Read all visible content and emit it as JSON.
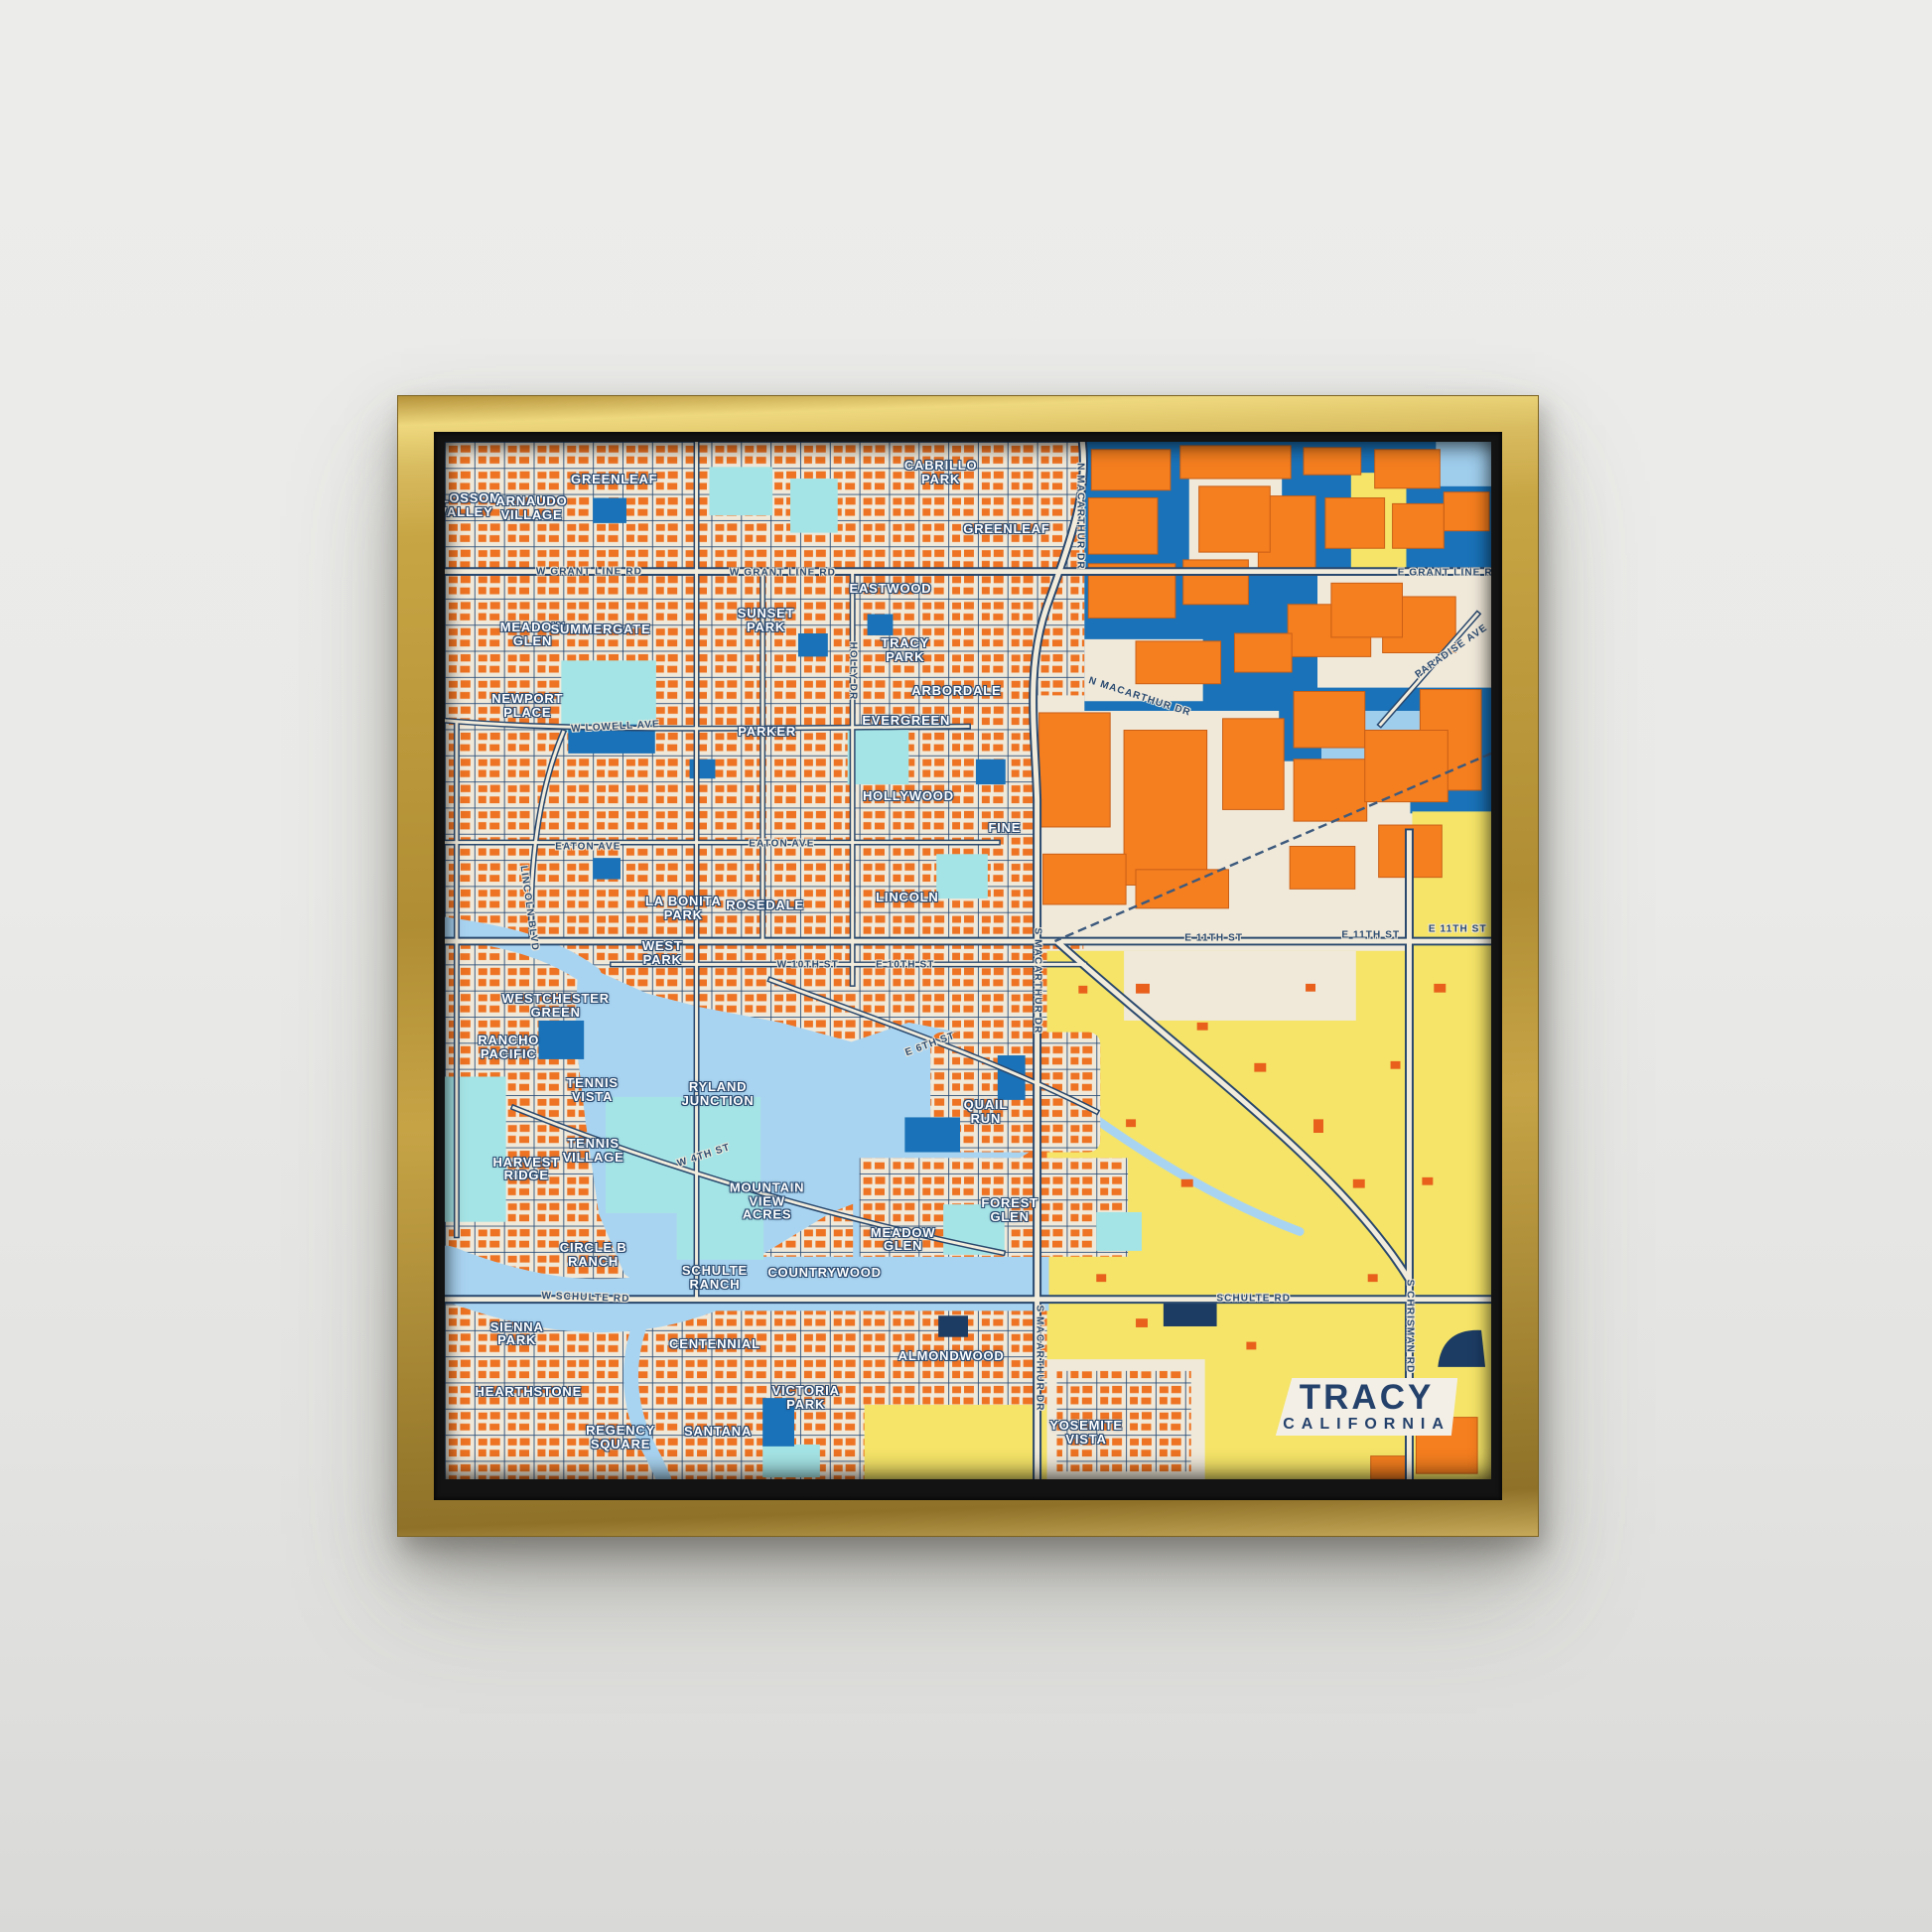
{
  "title_card": {
    "city": "TRACY",
    "state": "CALIFORNIA"
  },
  "palette": {
    "wall": "#eaeae8",
    "frame_gold": "#c7a544",
    "frame_gold_light": "#eed87e",
    "frame_gold_dark": "#8f7228",
    "frame_lip": "#131313",
    "map_cream": "#f0e9da",
    "residential_orange": "#ee7322",
    "building_orange": "#f57e1f",
    "water_blue": "#a9d4f1",
    "industrial_blue": "#1a72b8",
    "light_blue": "#9fcdec",
    "pale_cyan": "#a5e4e6",
    "field_yellow": "#f5e468",
    "road_navy": "#29486d",
    "dark_navy": "#1d3c63",
    "neighborhood_label": "#ffffff",
    "road_label": "#2a4a70",
    "card_bg": "#f3efe7",
    "card_text": "#24416b"
  },
  "map": {
    "neighborhoods": [
      {
        "text": "BLOSSOM\nVALLEY",
        "x": 2.0,
        "y": 6.1
      },
      {
        "text": "ARNAUDO\nVILLAGE",
        "x": 8.3,
        "y": 6.4
      },
      {
        "text": "GREENLEAF",
        "x": 16.2,
        "y": 3.6
      },
      {
        "text": "CABRILLO\nPARK",
        "x": 47.4,
        "y": 3.0
      },
      {
        "text": "GREENLEAF",
        "x": 53.7,
        "y": 8.4
      },
      {
        "text": "EASTWOOD",
        "x": 42.6,
        "y": 14.2
      },
      {
        "text": "SUNSET\nPARK",
        "x": 30.7,
        "y": 17.2
      },
      {
        "text": "MEADOW\nGLEN",
        "x": 8.4,
        "y": 18.6
      },
      {
        "text": "SUMMERGATE",
        "x": 14.9,
        "y": 18.1
      },
      {
        "text": "TRACY\nPARK",
        "x": 44.0,
        "y": 20.1
      },
      {
        "text": "ARBORDALE",
        "x": 48.9,
        "y": 24.0
      },
      {
        "text": "EVERGREEN",
        "x": 44.1,
        "y": 26.9
      },
      {
        "text": "NEWPORT\nPLACE",
        "x": 7.9,
        "y": 25.5
      },
      {
        "text": "PARKER",
        "x": 30.8,
        "y": 27.9
      },
      {
        "text": "HOLLYWOOD",
        "x": 44.3,
        "y": 34.2
      },
      {
        "text": "FINE",
        "x": 53.5,
        "y": 37.2
      },
      {
        "text": "LA BONITA\nPARK",
        "x": 22.8,
        "y": 45.0
      },
      {
        "text": "ROSEDALE",
        "x": 30.6,
        "y": 44.7
      },
      {
        "text": "LINCOLN",
        "x": 44.2,
        "y": 43.9
      },
      {
        "text": "WEST\nPARK",
        "x": 20.8,
        "y": 49.3
      },
      {
        "text": "WESTCHESTER\nGREEN",
        "x": 10.6,
        "y": 54.4
      },
      {
        "text": "RANCHO\nPACIFIC",
        "x": 6.1,
        "y": 58.4
      },
      {
        "text": "RYLAND\nJUNCTION",
        "x": 26.1,
        "y": 62.9
      },
      {
        "text": "QUAIL\nRUN",
        "x": 51.7,
        "y": 64.6
      },
      {
        "text": "TENNIS\nVISTA",
        "x": 14.1,
        "y": 62.5
      },
      {
        "text": "TENNIS\nVILLAGE",
        "x": 14.2,
        "y": 68.3
      },
      {
        "text": "HARVEST\nRIDGE",
        "x": 7.8,
        "y": 70.1
      },
      {
        "text": "MOUNTAIN\nVIEW\nACRES",
        "x": 30.8,
        "y": 73.2
      },
      {
        "text": "FOREST\nGLEN",
        "x": 54.0,
        "y": 74.1
      },
      {
        "text": "MEADOW\nGLEN",
        "x": 43.8,
        "y": 76.9
      },
      {
        "text": "CIRCLE B\nRANCH",
        "x": 14.2,
        "y": 78.4
      },
      {
        "text": "SCHULTE\nRANCH",
        "x": 25.8,
        "y": 80.6
      },
      {
        "text": "COUNTRYWOOD",
        "x": 36.3,
        "y": 80.1
      },
      {
        "text": "SIENNA\nPARK",
        "x": 6.9,
        "y": 86.0
      },
      {
        "text": "CENTENNIAL",
        "x": 25.8,
        "y": 87.0
      },
      {
        "text": "ALMONDWOOD",
        "x": 48.4,
        "y": 88.1
      },
      {
        "text": "HEARTHSTONE",
        "x": 8.0,
        "y": 91.6
      },
      {
        "text": "REGENCY\nSQUARE",
        "x": 16.8,
        "y": 96.0
      },
      {
        "text": "SANTANA",
        "x": 26.1,
        "y": 95.4
      },
      {
        "text": "VICTORIA\nPARK",
        "x": 34.5,
        "y": 92.2
      },
      {
        "text": "YOSEMITE\nVISTA",
        "x": 61.3,
        "y": 95.5
      }
    ],
    "roads": [
      {
        "text": "W GRANT LINE RD",
        "x": 13.8,
        "y": 12.5,
        "rot": 0
      },
      {
        "text": "W GRANT LINE RD",
        "x": 32.3,
        "y": 12.6,
        "rot": 0
      },
      {
        "text": "E GRANT LINE RD",
        "x": 96.0,
        "y": 12.6,
        "rot": 0
      },
      {
        "text": "N MACARTHUR DR",
        "x": 60.7,
        "y": 7.2,
        "rot": 90
      },
      {
        "text": "PARADISE AVE",
        "x": 96.2,
        "y": 20.2,
        "rot": -35
      },
      {
        "text": "W LOWELL AVE",
        "x": 16.3,
        "y": 27.5,
        "rot": -3
      },
      {
        "text": "HOLLY DR",
        "x": 39.0,
        "y": 22.1,
        "rot": 90
      },
      {
        "text": "EATON AVE",
        "x": 13.7,
        "y": 39.0,
        "rot": 0
      },
      {
        "text": "EATON AVE",
        "x": 32.2,
        "y": 38.8,
        "rot": 0
      },
      {
        "text": "LINCOLN BLVD",
        "x": 8.1,
        "y": 45.0,
        "rot": 82
      },
      {
        "text": "N MACARTHUR DR",
        "x": 66.4,
        "y": 24.6,
        "rot": 18
      },
      {
        "text": "W 10TH ST",
        "x": 34.7,
        "y": 50.4,
        "rot": 0
      },
      {
        "text": "E 10TH ST",
        "x": 44.0,
        "y": 50.4,
        "rot": 0
      },
      {
        "text": "E 11TH ST",
        "x": 73.5,
        "y": 47.8,
        "rot": 0
      },
      {
        "text": "E 11TH ST",
        "x": 88.5,
        "y": 47.6,
        "rot": 0
      },
      {
        "text": "E 11TH ST",
        "x": 96.8,
        "y": 47.0,
        "rot": 0
      },
      {
        "text": "S MACARTHUR DR",
        "x": 56.6,
        "y": 52.0,
        "rot": 90
      },
      {
        "text": "E 6TH ST",
        "x": 46.4,
        "y": 58.1,
        "rot": -20
      },
      {
        "text": "W 4TH ST",
        "x": 24.8,
        "y": 68.8,
        "rot": -18
      },
      {
        "text": "W SCHULTE RD",
        "x": 13.5,
        "y": 82.5,
        "rot": 2
      },
      {
        "text": "SCHULTE RD",
        "x": 77.3,
        "y": 82.6,
        "rot": 0
      },
      {
        "text": "S MACARTHUR DR",
        "x": 56.8,
        "y": 88.3,
        "rot": 90
      },
      {
        "text": "S CHRISMAN RD",
        "x": 92.2,
        "y": 85.3,
        "rot": 90
      }
    ]
  }
}
